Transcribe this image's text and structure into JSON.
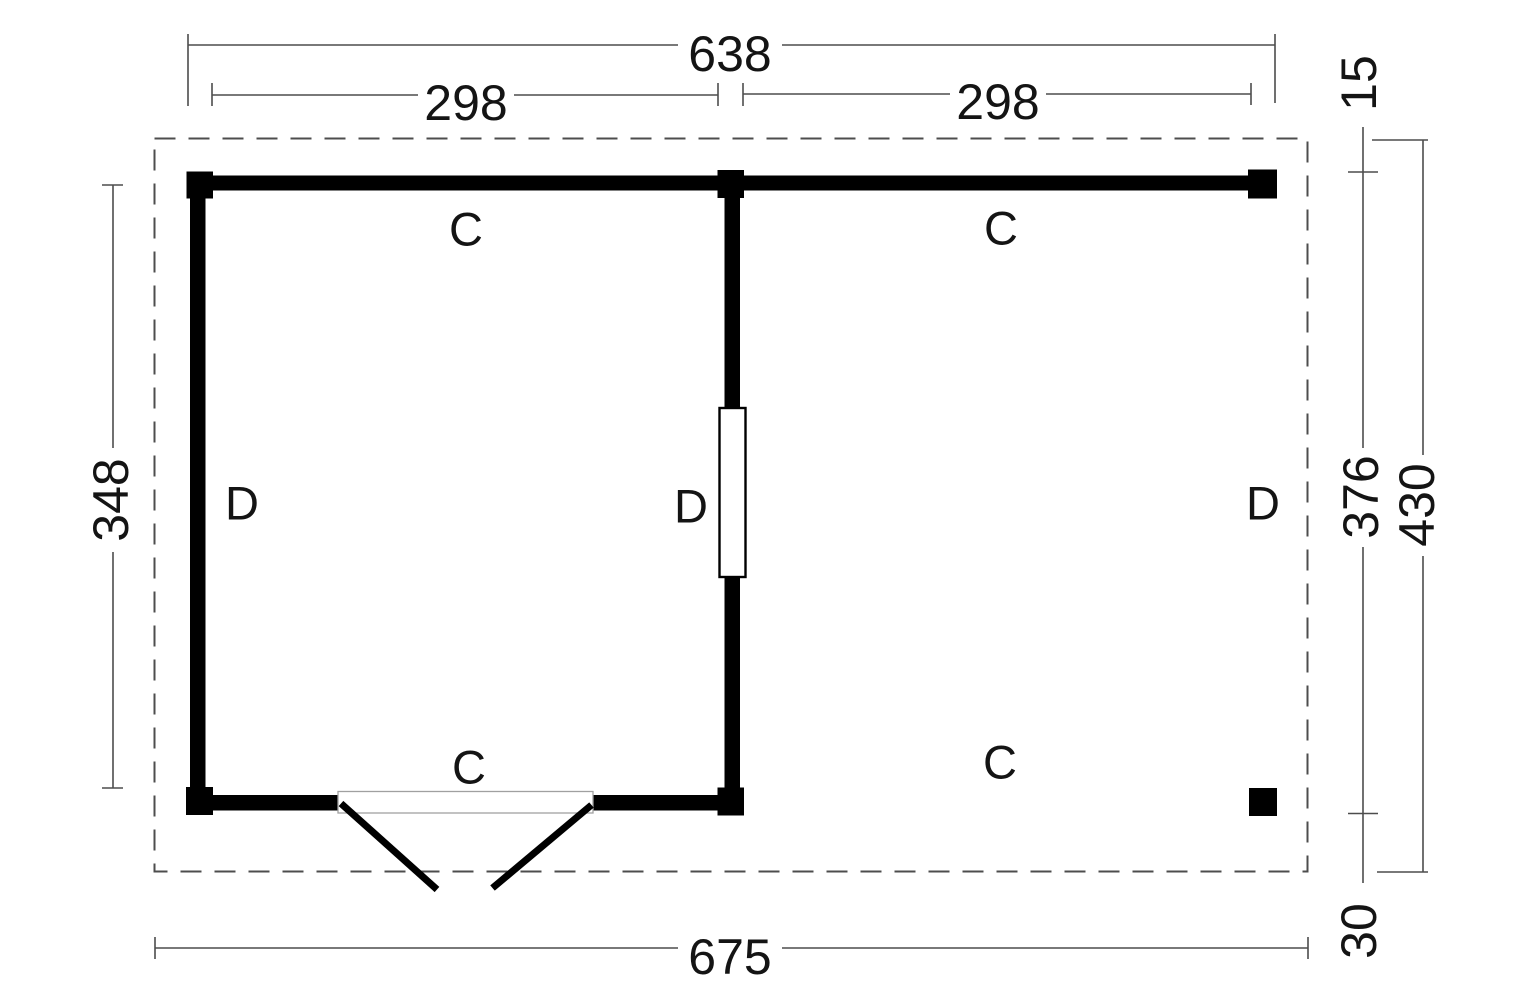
{
  "diagram": {
    "type": "floor-plan",
    "description": "Garden house floor plan with enclosed room (double doors), middle dividing wall with window, and open canopy bay",
    "dimensions": {
      "top_total": "638",
      "top_left_bay": "298",
      "top_right_bay": "298",
      "left_height": "348",
      "right_top_offset": "15",
      "right_wall_height": "376",
      "right_total_height": "430",
      "right_bottom_offset": "30",
      "bottom_total": "675"
    },
    "labels": {
      "c": "C",
      "d": "D"
    },
    "colors": {
      "wall": "#000000",
      "roof_outline": "#4d4d4d",
      "dimension_line": "#4d4d4d",
      "text": "#141414",
      "background": "#ffffff"
    }
  }
}
